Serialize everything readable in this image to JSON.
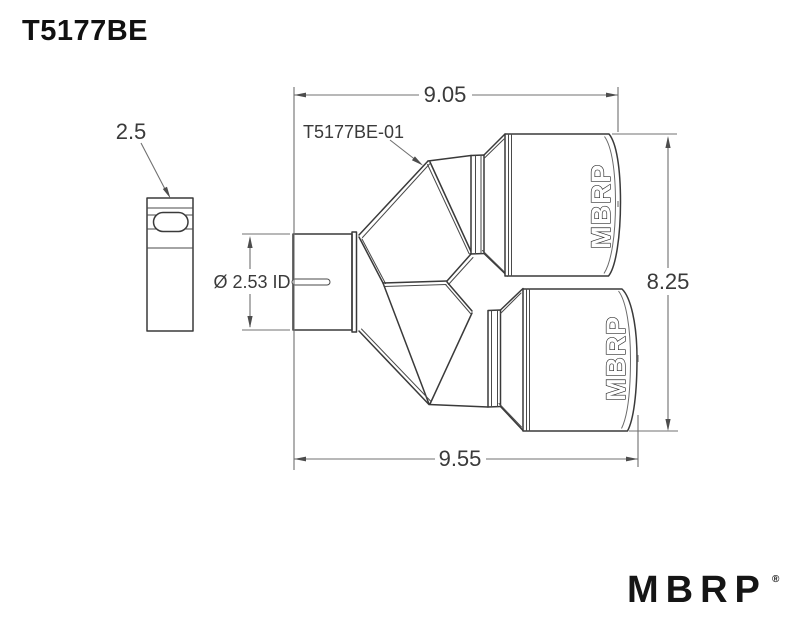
{
  "page": {
    "title": "T5177BE"
  },
  "drawing": {
    "part_label": "T5177BE-01",
    "dims": {
      "top_width": "9.05",
      "clamp_size": "2.5",
      "inlet_id": "Ø 2.53 ID",
      "overall_height": "8.25",
      "bottom_width": "9.55"
    },
    "tip_brand": "MBRP"
  },
  "footer": {
    "brand": "MBRP",
    "reg": "®"
  },
  "colors": {
    "background": "#ffffff",
    "part_line": "#3a3a3a",
    "dimension_line": "#707070",
    "text": "#3a3a3a",
    "logo": "#151515"
  }
}
